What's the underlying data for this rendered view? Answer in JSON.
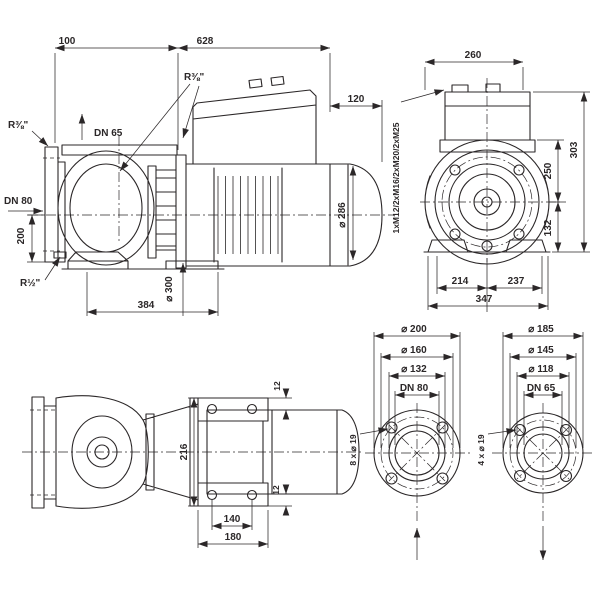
{
  "drawing": {
    "background": "#ffffff",
    "line_color": "#2b2728",
    "side_view": {
      "dim_100": "100",
      "dim_628": "628",
      "dim_120": "120",
      "dim_200": "200",
      "dim_motor_diameter": "⌀ 286",
      "dim_lantern_diameter": "⌀ 300",
      "dim_384": "384",
      "port_gauge": "R⅜\"",
      "port_gauge_suction": "R⅜\"",
      "port_drain": "R½\"",
      "discharge_label": "DN 65",
      "suction_label": "DN 80"
    },
    "front_view": {
      "dim_260": "260",
      "dim_303": "303",
      "dim_250": "250",
      "dim_132": "132",
      "dim_214": "214",
      "dim_237": "237",
      "dim_347": "347",
      "cable_glands": "1xM12/2xM16/2xM20/2xM25"
    },
    "plan_view": {
      "dim_12_top": "12",
      "dim_12_bottom": "12",
      "dim_216": "216",
      "dim_140": "140",
      "dim_180": "180"
    },
    "flange_dn80": {
      "outer_diameter": "⌀ 200",
      "bolt_circle": "⌀ 160",
      "face_diameter": "⌀ 132",
      "nominal": "DN 80",
      "bolt_holes": "8 x ⌀ 19"
    },
    "flange_dn65": {
      "outer_diameter": "⌀ 185",
      "bolt_circle": "⌀ 145",
      "face_diameter": "⌀ 118",
      "nominal": "DN 65",
      "bolt_holes": "4 x ⌀ 19"
    }
  }
}
